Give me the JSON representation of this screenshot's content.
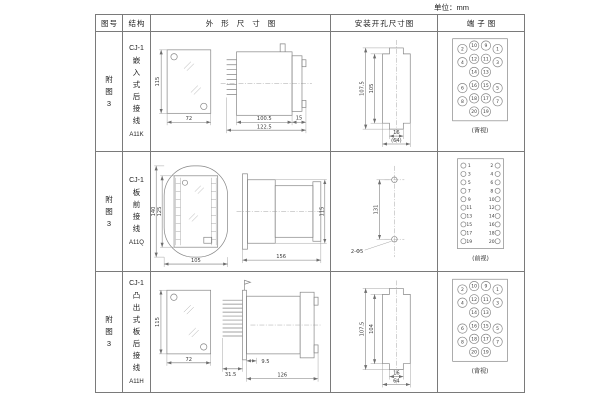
{
  "unit_note": "单位：mm",
  "headers": [
    "图号",
    "结构",
    "外形尺寸图",
    "安装开孔尺寸图",
    "端子图"
  ],
  "rows": [
    {
      "figure_no": "附图3",
      "series": "CJ-1",
      "structure": "嵌入式后接线",
      "model": "A11K",
      "outline": {
        "front_height": "115",
        "front_width": "72",
        "depth_body": "100.5",
        "depth_total": "122.5",
        "front_clearance": "15"
      },
      "mounting": {
        "outer_height": "107.5",
        "inner_height": "105",
        "slot_width": "16",
        "span": "(64)"
      },
      "terminal": {
        "view": "(背视)",
        "nums": [
          "2",
          "10",
          "9",
          "1",
          "4",
          "12",
          "11",
          "3",
          "14",
          "13",
          "6",
          "16",
          "15",
          "5",
          "8",
          "18",
          "17",
          "7",
          "20",
          "19"
        ]
      }
    },
    {
      "figure_no": "附图3",
      "series": "CJ-1",
      "structure": "板前接线",
      "model": "A11Q",
      "outline": {
        "front_height": "140",
        "inner_height": "125",
        "front_width": "105",
        "depth_total": "156",
        "side_height": "115"
      },
      "mounting": {
        "hole_span": "131",
        "holes": "2-Φ5"
      },
      "terminal": {
        "view": "(前视)",
        "left": [
          "1",
          "3",
          "5",
          "7",
          "9",
          "11",
          "13",
          "15",
          "17",
          "19"
        ],
        "right": [
          "2",
          "4",
          "6",
          "8",
          "10",
          "12",
          "14",
          "16",
          "18",
          "20"
        ]
      }
    },
    {
      "figure_no": "附图3",
      "series": "CJ-1",
      "structure": "凸出式板后接线",
      "model": "A11H",
      "outline": {
        "front_height": "115",
        "front_width": "72",
        "pin_length": "31.5",
        "panel_offset": "9.5",
        "depth_body": "126"
      },
      "mounting": {
        "outer_height": "107.5",
        "inner_height": "104",
        "slot_width": "16",
        "span": "64"
      },
      "terminal": {
        "view": "(背视)",
        "nums": [
          "2",
          "10",
          "9",
          "1",
          "4",
          "12",
          "11",
          "3",
          "14",
          "13",
          "6",
          "16",
          "15",
          "5",
          "8",
          "18",
          "17",
          "7",
          "20",
          "19"
        ]
      }
    }
  ]
}
